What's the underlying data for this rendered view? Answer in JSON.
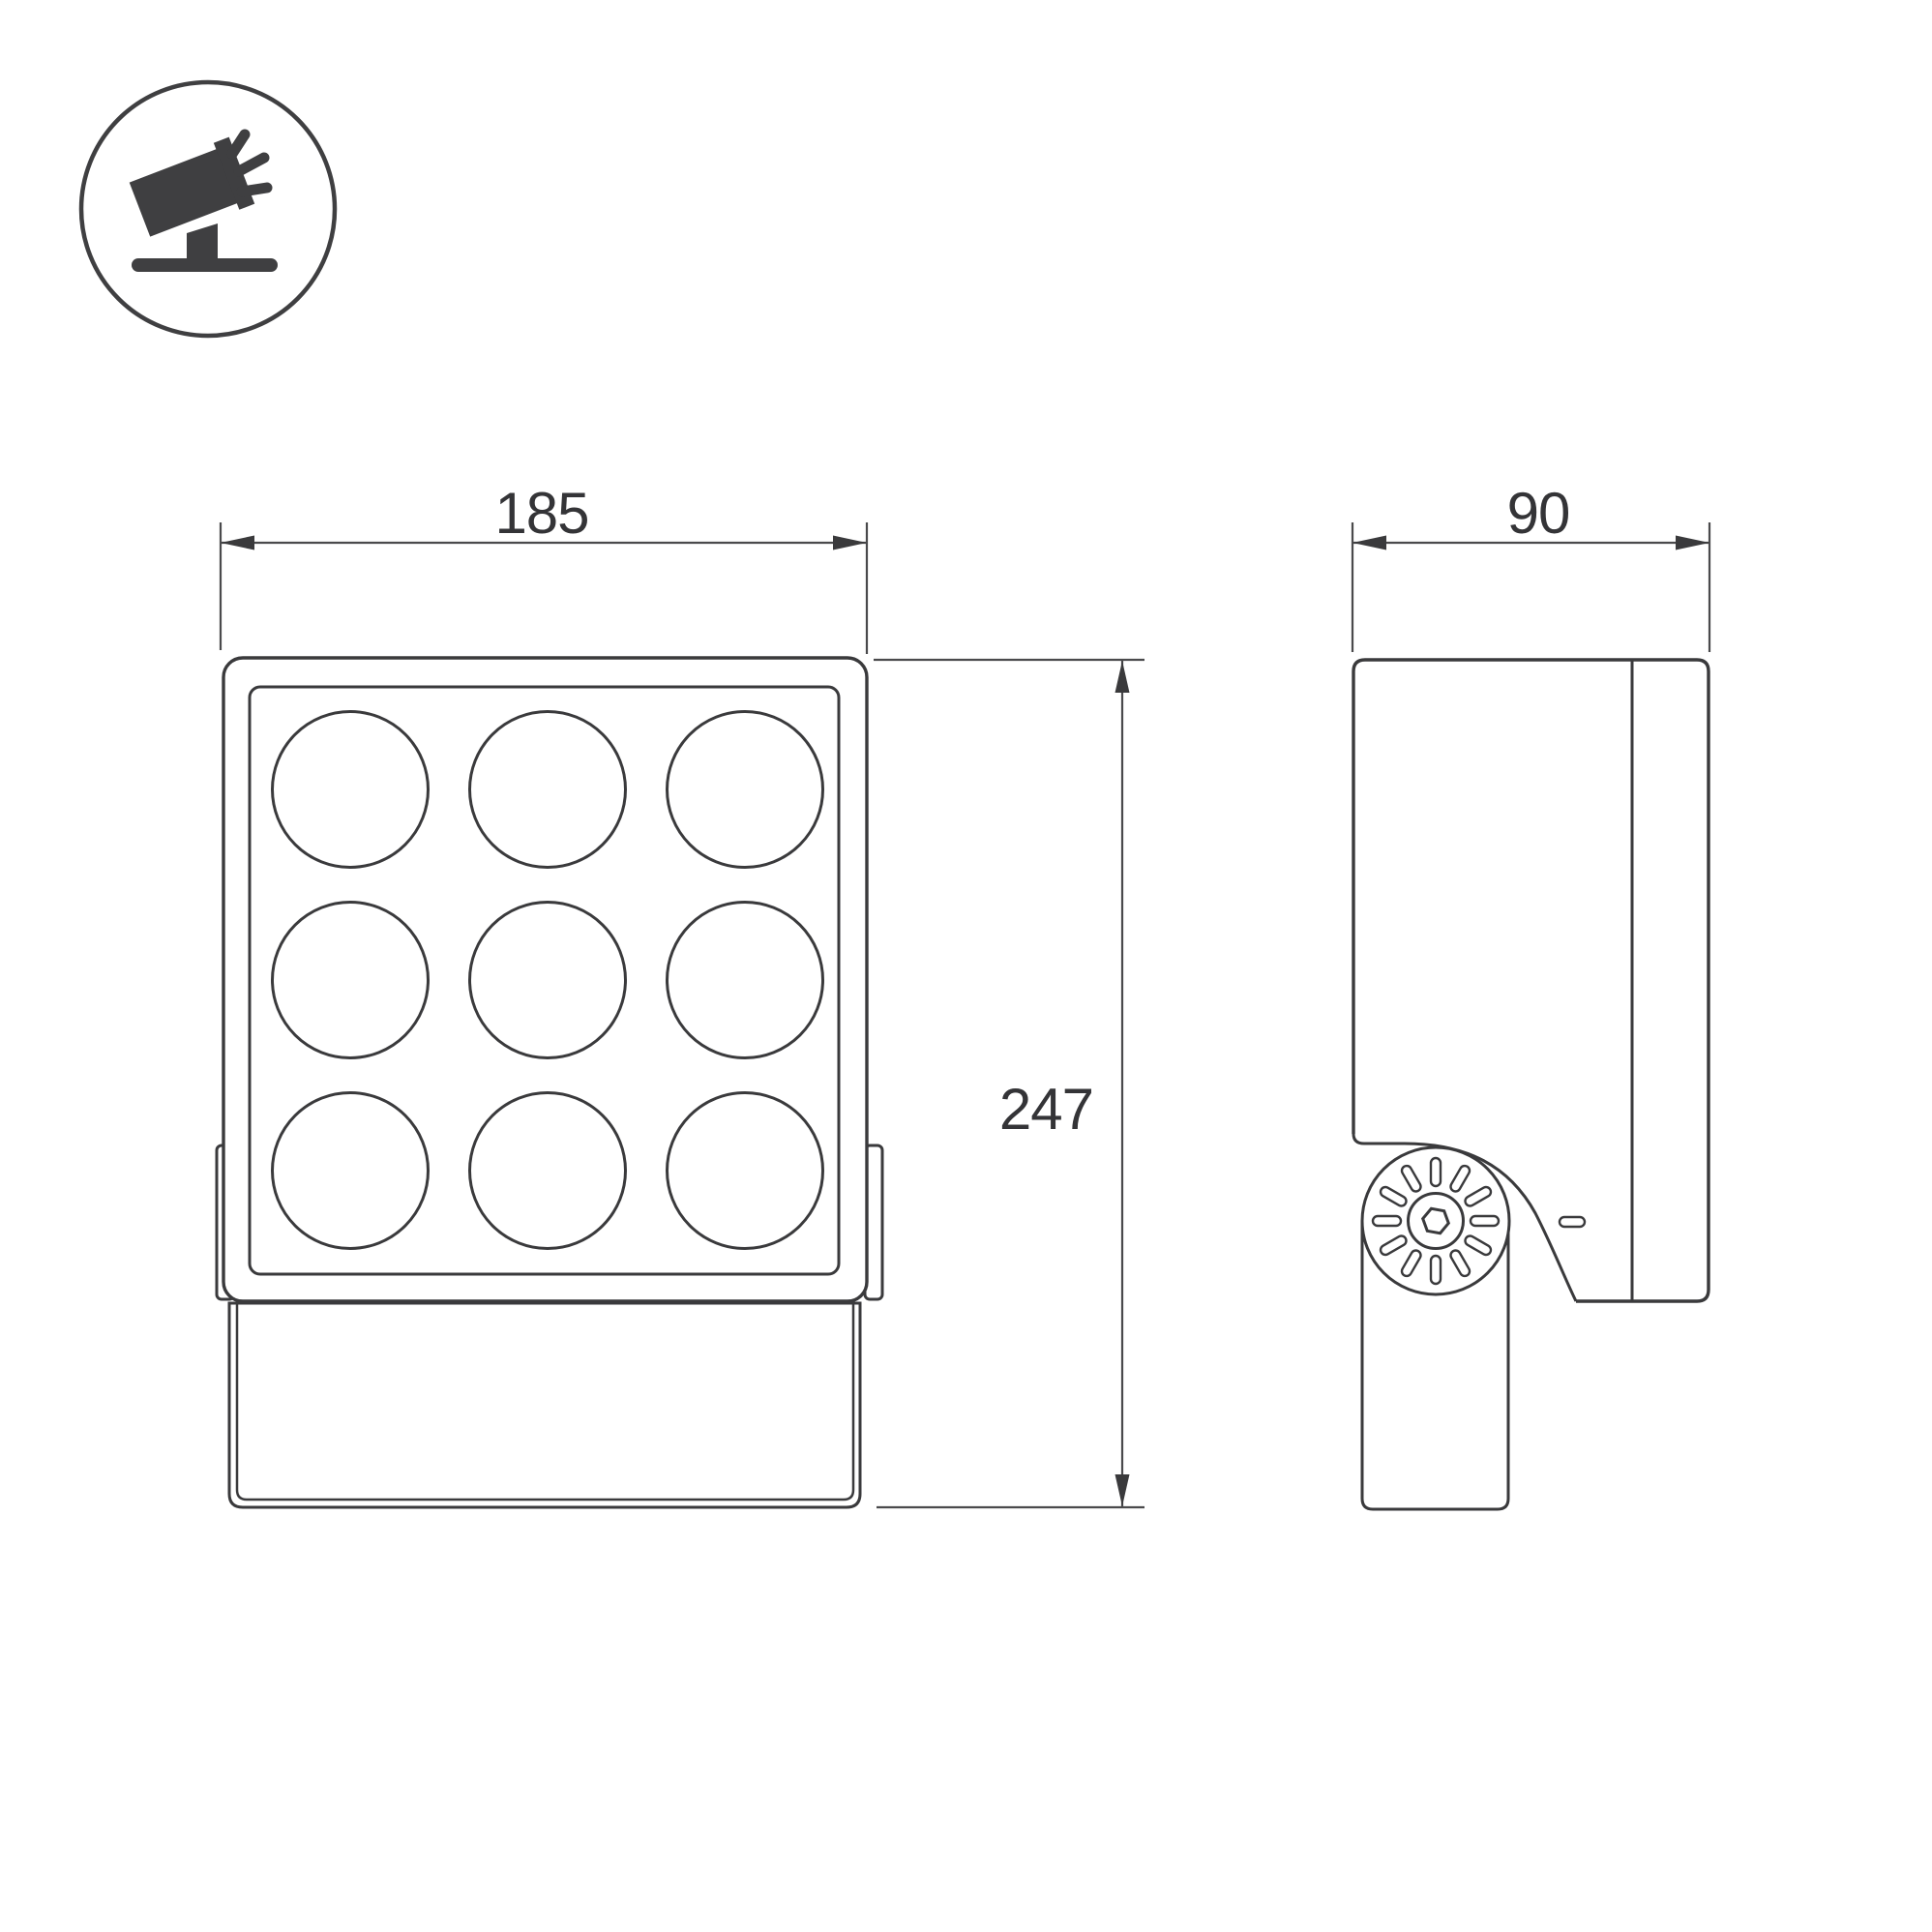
{
  "drawing": {
    "background": "#ffffff",
    "outline_color": "#3a3a3c",
    "dimension_color": "#4a4a4c",
    "icon_fill": "#3f3f41",
    "icon": {
      "name": "tilted-floodlight-on-stand",
      "rays": 3
    },
    "front_view": {
      "width_label": "185",
      "height_label": "247",
      "led_grid": {
        "rows": 3,
        "cols": 3,
        "lens_count": 9
      }
    },
    "side_view": {
      "depth_label": "90",
      "knob_slot_count": 12
    }
  }
}
